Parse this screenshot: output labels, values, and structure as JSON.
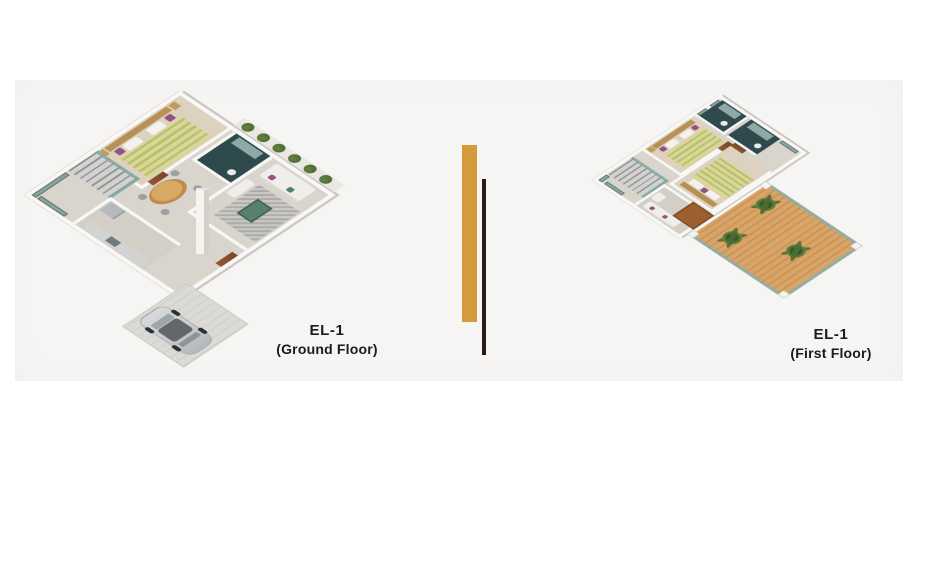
{
  "canvas": {
    "page_background": "#ffffff",
    "image_background": "#f6f5f3"
  },
  "divider": {
    "gold_bar_color": "#d59a3b",
    "dark_bar_color": "#2a1b17"
  },
  "plans": [
    {
      "id": "ground-floor",
      "label_line1": "EL-1",
      "label_line2": "(Ground Floor)"
    },
    {
      "id": "first-floor",
      "label_line1": "EL-1",
      "label_line2": "(First Floor)"
    }
  ],
  "palette": {
    "page_bg": "#ffffff",
    "canvas_bg": "#f6f5f3",
    "gold": "#d59a3b",
    "darkbar": "#2a1b17",
    "label_color": "#1b1b1b",
    "wall": "#f8f8f6",
    "floor": "#d9d5cd",
    "floor2": "#d3cfc7",
    "bedroomfloor": "#dcd2bf",
    "bath": "#2f4a4c",
    "bathfix": "#8fa9a7",
    "glass": "#7fa7a3",
    "frame": "#5f5b53",
    "door": "#7a4526",
    "wood": "#c08a4a",
    "woodlight": "#d8a964",
    "duvet1": "#d8d795",
    "duvet2": "#b9be70",
    "pillow": "#f4f2ee",
    "accentpillow": "#94537f",
    "nightstand": "#c49a5f",
    "sofa": "#efeeea",
    "rug": "#b6b5b1",
    "coffee": "#57806f",
    "hedge": "#4c6a33",
    "hedgelight": "#648344",
    "drive": "#dbdad6",
    "car": "#c9ccce",
    "carroof": "#63676a",
    "steps1": "#d2d2d0",
    "steps2": "#8e8e8c",
    "counter": "#d3d3d1",
    "fridge": "#b6babc",
    "terracewood1": "#d8a468",
    "terracewood2": "#c89150",
    "palm1": "#2f4a20",
    "palm2": "#5d7f3a"
  }
}
